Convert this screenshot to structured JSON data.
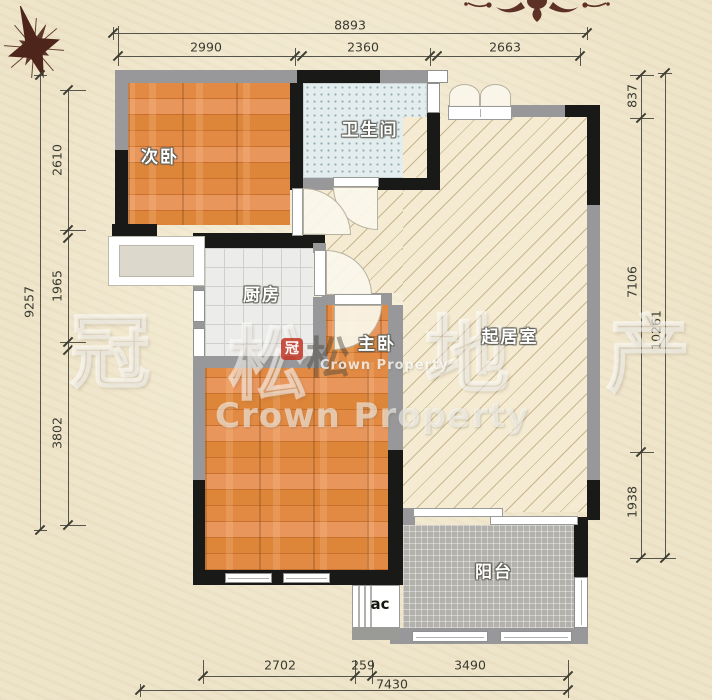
{
  "rooms": {
    "bedroom2": "次卧",
    "bathroom": "卫生间",
    "kitchen": "厨房",
    "master_bedroom": "主卧",
    "living_room": "起居室",
    "balcony": "阳台",
    "ac_unit": "ac"
  },
  "dims": {
    "top": {
      "total": "8893",
      "seg1": "2990",
      "seg2": "2360",
      "seg3": "2663"
    },
    "left": {
      "total": "9257",
      "seg1": "2610",
      "seg2": "1965",
      "seg3": "3802"
    },
    "right": {
      "total": "10261",
      "seg1": "837",
      "seg2": "7106",
      "seg3": "1938"
    },
    "bottom": {
      "total": "7430",
      "seg1": "2702",
      "seg2": "259",
      "seg3": "3490"
    }
  },
  "watermark": {
    "char1": "冠",
    "char2": "松",
    "char3": "地",
    "char4": "产",
    "brand": "Crown Property",
    "brand_small": "Crown Property",
    "logo_char": "冠",
    "logo_side_char": "松"
  },
  "icons": {
    "compass": "compass-rose",
    "ornament": "floral-damask-ornament"
  },
  "colors": {
    "paper": "#eee4c9",
    "wall_black": "#191917",
    "wall_gray": "#98989a",
    "wood_floor": "#e0873f",
    "living_floor": "#f4ebd2",
    "bath_floor": "#e4edee",
    "kitchen_floor": "#ececea",
    "balcony_floor": "#b3b1ab",
    "dimension_line": "#55554b",
    "compass": "#4d251a",
    "logo_red": "#c23726"
  }
}
